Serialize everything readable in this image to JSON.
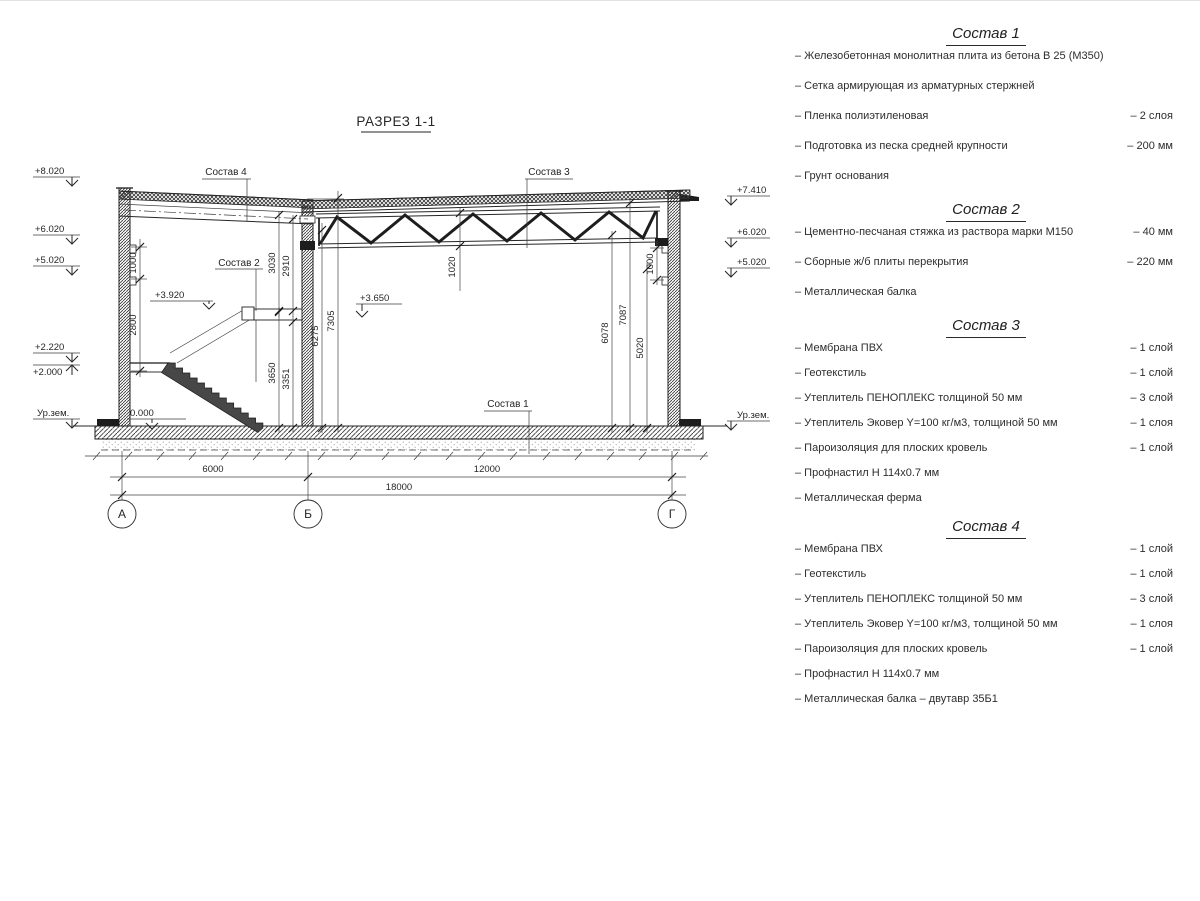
{
  "drawing": {
    "title": "РАЗРЕЗ 1-1",
    "axes": [
      "А",
      "Б",
      "Г"
    ],
    "spans": {
      "ab": "6000",
      "bg": "12000",
      "total": "18000"
    },
    "elev_left": [
      "+8.020",
      "+6.020",
      "+5.020",
      "+2.220",
      "+2.000",
      "Ур.зем."
    ],
    "elev_right": [
      "+7.410",
      "+6.020",
      "+5.020",
      "Ур.зем."
    ],
    "elev_inner": {
      "stair_upper": "+3.920",
      "hall": "+3.650",
      "floor": "0.000"
    },
    "dims": {
      "left_top": "1000",
      "left_bottom": "2800",
      "mid_a": "3030",
      "mid_b": "2910",
      "mid_c": "3650",
      "mid_d": "3351",
      "mid_e": "6275",
      "mid_f": "7305",
      "truss": "1020",
      "right_a": "6078",
      "right_b": "7087",
      "right_c": "5020",
      "right_d": "1000"
    },
    "leaders": {
      "l1": "Состав 1",
      "l2": "Состав 2",
      "l3": "Состав 3",
      "l4": "Состав 4"
    }
  },
  "legend": {
    "sections": [
      {
        "title": "Состав 1",
        "items": [
          {
            "label": "– Железобетонная  монолитная плита из бетона В 25 (М350)",
            "value": ""
          },
          {
            "label": "– Сетка армирующая из арматурных стержней",
            "value": ""
          },
          {
            "label": "– Пленка полиэтиленовая",
            "value": "– 2 слоя"
          },
          {
            "label": "– Подготовка из песка средней крупности",
            "value": "– 200 мм"
          },
          {
            "label": "– Грунт основания",
            "value": ""
          }
        ]
      },
      {
        "title": "Состав 2",
        "items": [
          {
            "label": "– Цементно-песчаная стяжка из раствора марки М150",
            "value": "– 40 мм"
          },
          {
            "label": "– Сборные ж/б плиты перекрытия",
            "value": "– 220 мм"
          },
          {
            "label": "– Металлическая балка",
            "value": ""
          }
        ]
      },
      {
        "title": "Состав 3",
        "items": [
          {
            "label": "– Мембрана ПВХ",
            "value": "– 1 слой"
          },
          {
            "label": "– Геотекстиль",
            "value": "– 1 слой"
          },
          {
            "label": "– Утеплитель ПЕНОПЛЕКС толщиной 50 мм",
            "value": "– 3 слой"
          },
          {
            "label": "– Утеплитель Эковер Y=100 кг/м3, толщиной 50 мм",
            "value": "– 1 слоя"
          },
          {
            "label": "– Пароизоляция для плоских кровель",
            "value": "– 1 слой"
          },
          {
            "label": "– Профнастил Н 114х0.7 мм",
            "value": ""
          },
          {
            "label": "– Металлическая ферма",
            "value": ""
          }
        ]
      },
      {
        "title": "Состав 4",
        "items": [
          {
            "label": "– Мембрана ПВХ",
            "value": "– 1 слой"
          },
          {
            "label": "– Геотекстиль",
            "value": "– 1 слой"
          },
          {
            "label": "– Утеплитель ПЕНОПЛЕКС толщиной 50 мм",
            "value": "– 3 слой"
          },
          {
            "label": "– Утеплитель Эковер Y=100 кг/м3, толщиной 50 мм",
            "value": "– 1 слоя"
          },
          {
            "label": "– Пароизоляция для плоских кровель",
            "value": "– 1 слой"
          },
          {
            "label": "– Профнастил Н 114х0.7 мм",
            "value": ""
          },
          {
            "label": "– Металлическая балка – двутавр 35Б1",
            "value": ""
          }
        ]
      }
    ]
  }
}
